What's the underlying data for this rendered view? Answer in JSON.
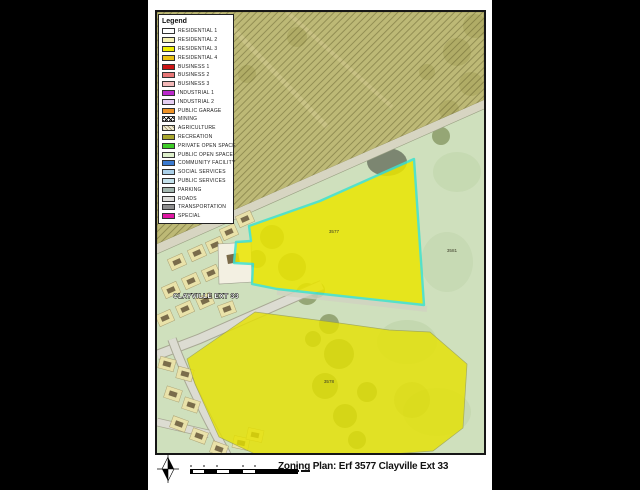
{
  "window": {
    "background": "#000000"
  },
  "sheet": {
    "background": "#ffffff"
  },
  "legend": {
    "title": "Legend",
    "items": [
      {
        "label": "RESIDENTIAL 1",
        "color": "#ffffff",
        "pattern": "plain"
      },
      {
        "label": "RESIDENTIAL 2",
        "color": "#f7f3b5",
        "pattern": "plain"
      },
      {
        "label": "RESIDENTIAL 3",
        "color": "#f0ee00",
        "pattern": "plain"
      },
      {
        "label": "RESIDENTIAL 4",
        "color": "#eac214",
        "pattern": "plain"
      },
      {
        "label": "BUSINESS 1",
        "color": "#cc1414",
        "pattern": "plain"
      },
      {
        "label": "BUSINESS 2",
        "color": "#e87676",
        "pattern": "plain"
      },
      {
        "label": "BUSINESS 3",
        "color": "#f3b8b8",
        "pattern": "plain"
      },
      {
        "label": "INDUSTRIAL 1",
        "color": "#bb29cc",
        "pattern": "plain"
      },
      {
        "label": "INDUSTRIAL 2",
        "color": "#e5cef2",
        "pattern": "plain"
      },
      {
        "label": "PUBLIC GARAGE",
        "color": "#ef9226",
        "pattern": "plain"
      },
      {
        "label": "MINING",
        "color": "#ffffff",
        "pattern": "crosshatch"
      },
      {
        "label": "AGRICULTURE",
        "color": "#f0ead2",
        "pattern": "hatch"
      },
      {
        "label": "RECREATION",
        "color": "#a9a72e",
        "pattern": "plain"
      },
      {
        "label": "PRIVATE OPEN SPACE",
        "color": "#3ecc28",
        "pattern": "plain"
      },
      {
        "label": "PUBLIC OPEN SPACE",
        "color": "#def0cb",
        "pattern": "plain"
      },
      {
        "label": "COMMUNITY FACILITY",
        "color": "#3a7ad0",
        "pattern": "plain"
      },
      {
        "label": "SOCIAL SERVICES",
        "color": "#a9cfe8",
        "pattern": "plain"
      },
      {
        "label": "PUBLIC SERVICES",
        "color": "#c4e2ec",
        "pattern": "plain"
      },
      {
        "label": "PARKING",
        "color": "#a3b7af",
        "pattern": "plain"
      },
      {
        "label": "ROADS",
        "color": "#dededa",
        "pattern": "plain"
      },
      {
        "label": "TRANSPORTATION",
        "color": "#8e8e8e",
        "pattern": "plain"
      },
      {
        "label": "SPECIAL",
        "color": "#de17a2",
        "pattern": "plain"
      }
    ]
  },
  "map": {
    "area_label": "CLAYVILLE EXT 33",
    "parcel_labels": [
      {
        "text": "3577",
        "x": 177,
        "y": 221
      },
      {
        "text": "3578",
        "x": 172,
        "y": 371
      },
      {
        "text": "3581",
        "x": 295,
        "y": 240
      }
    ],
    "colors": {
      "open_space": "#cfe0bd",
      "agriculture": "#b7ae62",
      "subject_fill": "#ebe600",
      "subject_outline": "#40e2cc",
      "road": "#dcdcd2"
    }
  },
  "footer": {
    "title": "Zoning Plan: Erf 3577 Clayville Ext 33"
  }
}
